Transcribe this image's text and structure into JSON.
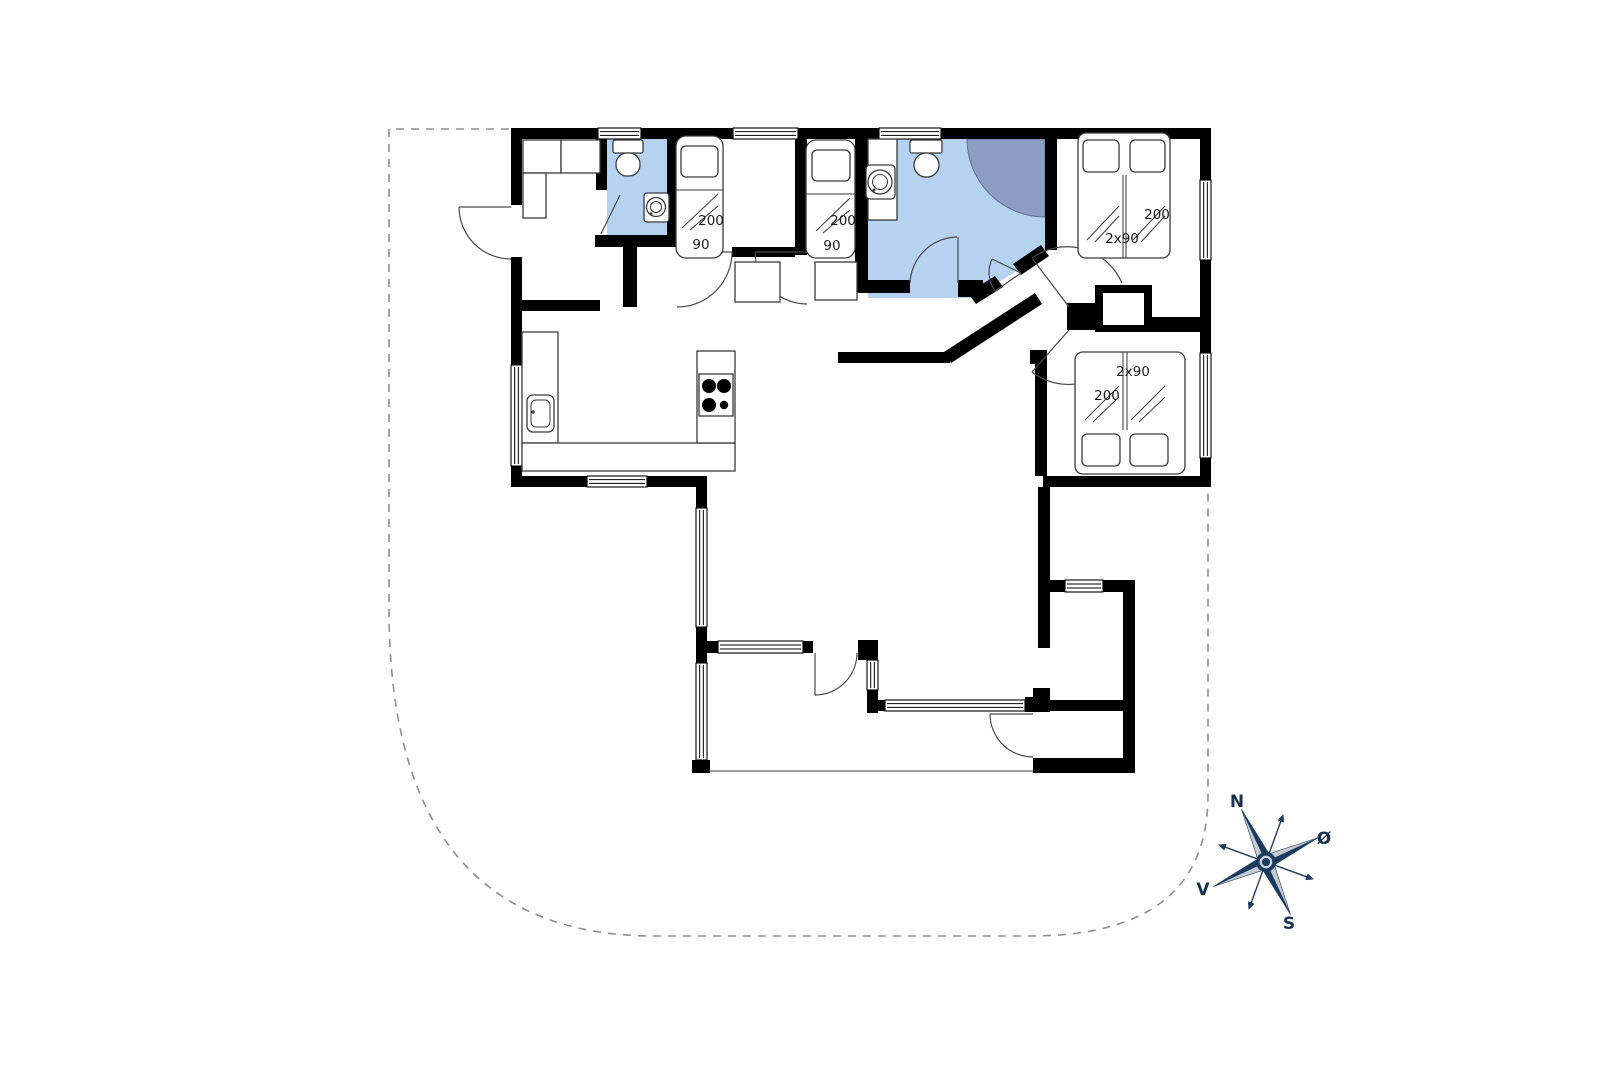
{
  "floorplan": {
    "beds": {
      "single_left": {
        "length": "200",
        "width": "90"
      },
      "single_right": {
        "length": "200",
        "width": "90"
      },
      "double_top_right": {
        "length": "200",
        "width": "2x90"
      },
      "double_bottom_right": {
        "length": "200",
        "width": "2x90"
      }
    },
    "compass": {
      "north": "N",
      "east": "Ø",
      "south": "S",
      "west": "V"
    },
    "colors": {
      "wall": "#000000",
      "bathroom_floor": "#b5d2f0",
      "shower": "#8b9fc4",
      "furniture_outline": "#3a3a3a",
      "boundary_dash": "#8f8f8f",
      "compass_primary": "#1d3a5f",
      "compass_accent": "#c3cad2"
    }
  }
}
